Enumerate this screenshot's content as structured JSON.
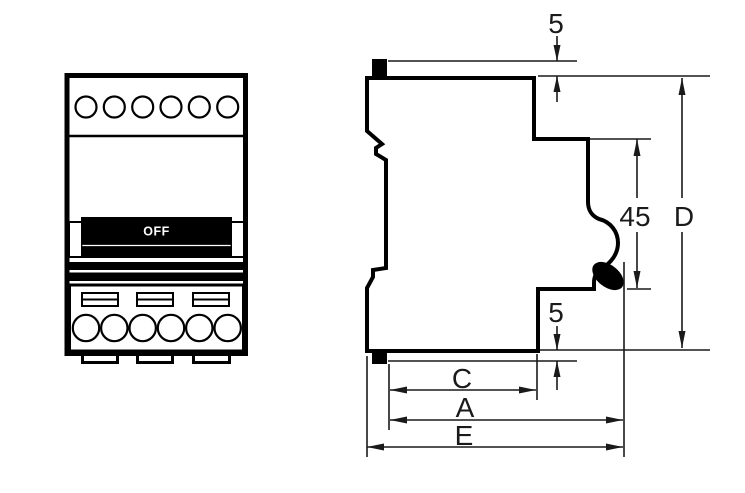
{
  "drawing": {
    "front_view": {
      "toggle_state_label": "OFF"
    },
    "dimensions": {
      "top_clip_protrusion": "5",
      "front_projection_height": "45",
      "overall_height": "D",
      "bottom_clip_protrusion": "5",
      "depth_to_recess": "C",
      "depth_overall_body": "A",
      "depth_overall_with_clip": "E"
    },
    "colors": {
      "line": "#000000",
      "dimension_line": "#1a1a1a",
      "background": "#ffffff",
      "toggle_band": "#000000",
      "toggle_text": "#ffffff"
    }
  }
}
